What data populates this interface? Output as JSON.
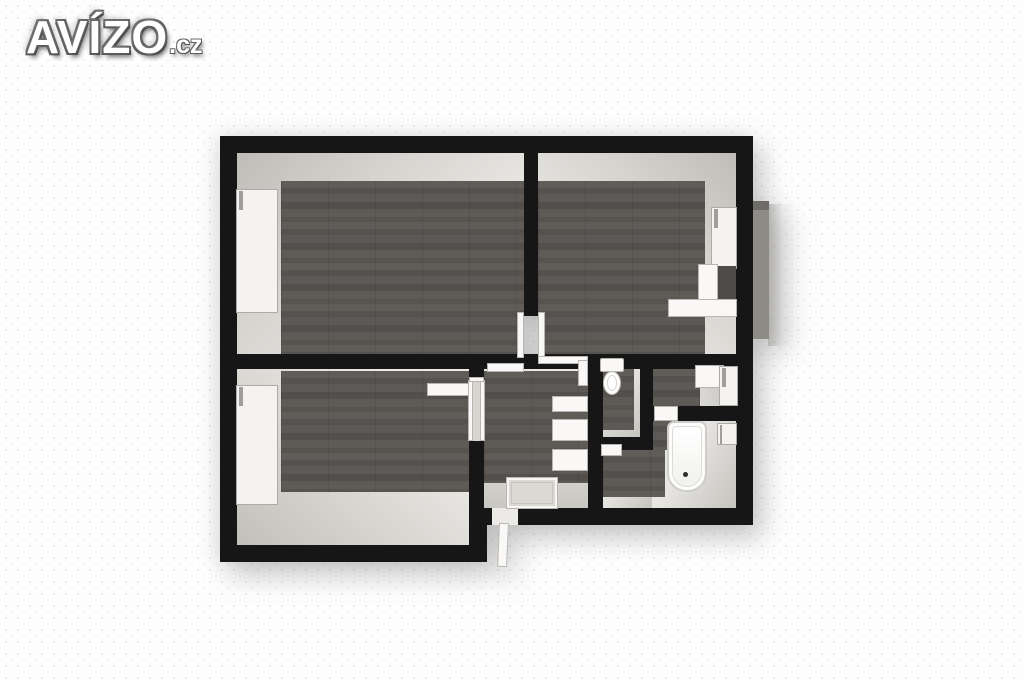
{
  "logo": {
    "brand": "AVÍZO",
    "tld": ".cz"
  },
  "palette": {
    "background": "#fefefe",
    "wall_black": "#161616",
    "wood_floor": "#585552",
    "wall_face_light": "#eceae6",
    "wall_face_shadow": "#bfbdb8",
    "fixture_white": "#f9f8f6",
    "balcony_gray": "#8d8b86"
  },
  "floor_plan": {
    "view": "top-down 3D apartment floor plan render",
    "rooms": [
      "room-top-left",
      "room-top-right",
      "room-bottom-left",
      "hallway",
      "wc",
      "small-room-right",
      "bathroom"
    ],
    "fixtures": [
      "window-top-left",
      "window-bottom-left",
      "window-top-right",
      "roller-blind",
      "window-bathroom",
      "desk-under-window",
      "wall-shelf",
      "hall-shelves",
      "doormat",
      "toilet",
      "bathtub",
      "entry-door",
      "balcony-panel"
    ]
  }
}
